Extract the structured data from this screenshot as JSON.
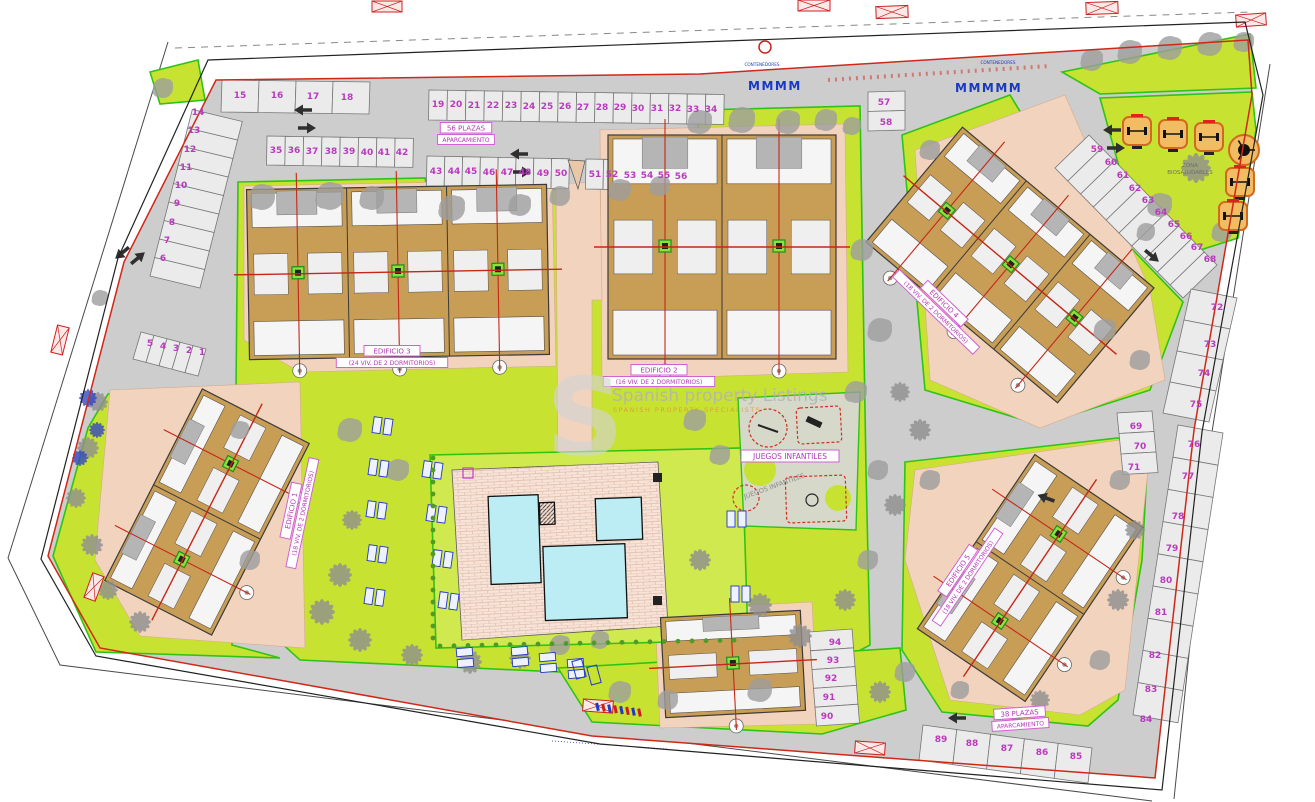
{
  "plan": {
    "type": "residential-site-plan",
    "watermark": {
      "logo_letter": "S",
      "line1": "Spanish property Listings",
      "line2": "SPANISH PROPERTY SPECIALISTS"
    },
    "colors": {
      "lawn": "#c8e232",
      "pool_lawn": "#cfe94e",
      "asphalt": "#cdcdcd",
      "building": "#c89d56",
      "pool": "#bdedf4",
      "label_magenta": "#b435b8",
      "boundary_red": "#d02818",
      "boundary_green": "#2ec415",
      "path_salmon": "#f2d3bd",
      "annotation_blue": "#2038c0",
      "fitness_orange": "#d2691e"
    },
    "buildings": [
      {
        "id": "edificio-1",
        "title": "EDIFICIO 1",
        "subtitle": "(18 VIV. DE 2 DORMITORIOS)"
      },
      {
        "id": "edificio-2",
        "title": "EDIFICIO 2",
        "subtitle": "(16 VIV. DE 2 DORMITORIOS)"
      },
      {
        "id": "edificio-3",
        "title": "EDIFICIO 3",
        "subtitle": "(24 VIV. DE 2 DORMITORIOS)"
      },
      {
        "id": "edificio-4",
        "title": "EDIFICIO 4",
        "subtitle": "(18 VIV. DE 2 DORMITORIOS)"
      },
      {
        "id": "edificio-5",
        "title": "EDIFICIO 5",
        "subtitle": "(18 VIV. DE 2 DORMITORIOS)"
      }
    ],
    "areas": {
      "playground": "JUEGOS INFANTILES",
      "playground_echo": "JUEGOS INFANTILES",
      "fitness_line1": "ZONA",
      "fitness_line2": "BIOSALUDABLES",
      "parking_top_line1": "56 PLAZAS",
      "parking_top_line2": "APARCAMIENTO",
      "parking_bottom_line1": "38 PLAZAS",
      "parking_bottom_line2": "APARCAMIENTO",
      "containers": "CONTENEDORES"
    },
    "parking_numbers": [
      [
        1,
        202,
        352
      ],
      [
        2,
        189,
        350
      ],
      [
        3,
        176,
        348
      ],
      [
        4,
        163,
        346
      ],
      [
        5,
        150,
        343
      ],
      [
        6,
        163,
        258
      ],
      [
        7,
        167,
        240
      ],
      [
        8,
        172,
        222
      ],
      [
        9,
        177,
        203
      ],
      [
        10,
        181,
        185
      ],
      [
        11,
        186,
        167
      ],
      [
        12,
        190,
        149
      ],
      [
        13,
        194,
        130
      ],
      [
        14,
        198,
        112
      ],
      [
        15,
        240,
        95
      ],
      [
        16,
        277,
        95
      ],
      [
        17,
        313,
        96
      ],
      [
        18,
        347,
        97
      ],
      [
        19,
        438,
        104
      ],
      [
        20,
        456,
        104
      ],
      [
        21,
        474,
        105
      ],
      [
        22,
        493,
        105
      ],
      [
        23,
        511,
        105
      ],
      [
        24,
        529,
        106
      ],
      [
        25,
        547,
        106
      ],
      [
        26,
        565,
        106
      ],
      [
        27,
        583,
        107
      ],
      [
        28,
        602,
        107
      ],
      [
        29,
        620,
        107
      ],
      [
        30,
        638,
        108
      ],
      [
        31,
        657,
        108
      ],
      [
        32,
        675,
        108
      ],
      [
        33,
        693,
        109
      ],
      [
        34,
        711,
        109
      ],
      [
        35,
        276,
        150
      ],
      [
        36,
        294,
        150
      ],
      [
        37,
        312,
        151
      ],
      [
        38,
        331,
        151
      ],
      [
        39,
        349,
        151
      ],
      [
        40,
        367,
        152
      ],
      [
        41,
        384,
        152
      ],
      [
        42,
        402,
        152
      ],
      [
        43,
        436,
        171
      ],
      [
        44,
        454,
        171
      ],
      [
        45,
        471,
        171
      ],
      [
        46,
        489,
        172
      ],
      [
        47,
        507,
        172
      ],
      [
        48,
        525,
        172
      ],
      [
        49,
        543,
        173
      ],
      [
        50,
        561,
        173
      ],
      [
        51,
        595,
        174
      ],
      [
        52,
        612,
        174
      ],
      [
        53,
        630,
        175
      ],
      [
        54,
        647,
        175
      ],
      [
        55,
        664,
        175
      ],
      [
        56,
        681,
        176
      ],
      [
        57,
        884,
        102
      ],
      [
        58,
        886,
        122
      ],
      [
        59,
        1097,
        149
      ],
      [
        60,
        1111,
        162
      ],
      [
        61,
        1123,
        175
      ],
      [
        62,
        1135,
        188
      ],
      [
        63,
        1148,
        200
      ],
      [
        64,
        1161,
        212
      ],
      [
        65,
        1174,
        224
      ],
      [
        66,
        1186,
        236
      ],
      [
        67,
        1197,
        247
      ],
      [
        68,
        1210,
        259
      ],
      [
        69,
        1136,
        426
      ],
      [
        70,
        1140,
        446
      ],
      [
        71,
        1134,
        467
      ],
      [
        72,
        1217,
        307
      ],
      [
        73,
        1210,
        344
      ],
      [
        74,
        1204,
        373
      ],
      [
        75,
        1196,
        404
      ],
      [
        76,
        1194,
        444
      ],
      [
        77,
        1188,
        476
      ],
      [
        78,
        1178,
        516
      ],
      [
        79,
        1172,
        548
      ],
      [
        80,
        1166,
        580
      ],
      [
        81,
        1161,
        612
      ],
      [
        82,
        1155,
        655
      ],
      [
        83,
        1151,
        689
      ],
      [
        84,
        1146,
        719
      ],
      [
        85,
        1076,
        756
      ],
      [
        86,
        1042,
        752
      ],
      [
        87,
        1007,
        748
      ],
      [
        88,
        972,
        743
      ],
      [
        89,
        941,
        739
      ],
      [
        90,
        827,
        716
      ],
      [
        91,
        829,
        697
      ],
      [
        92,
        831,
        678
      ],
      [
        93,
        833,
        660
      ],
      [
        94,
        835,
        642
      ]
    ]
  }
}
